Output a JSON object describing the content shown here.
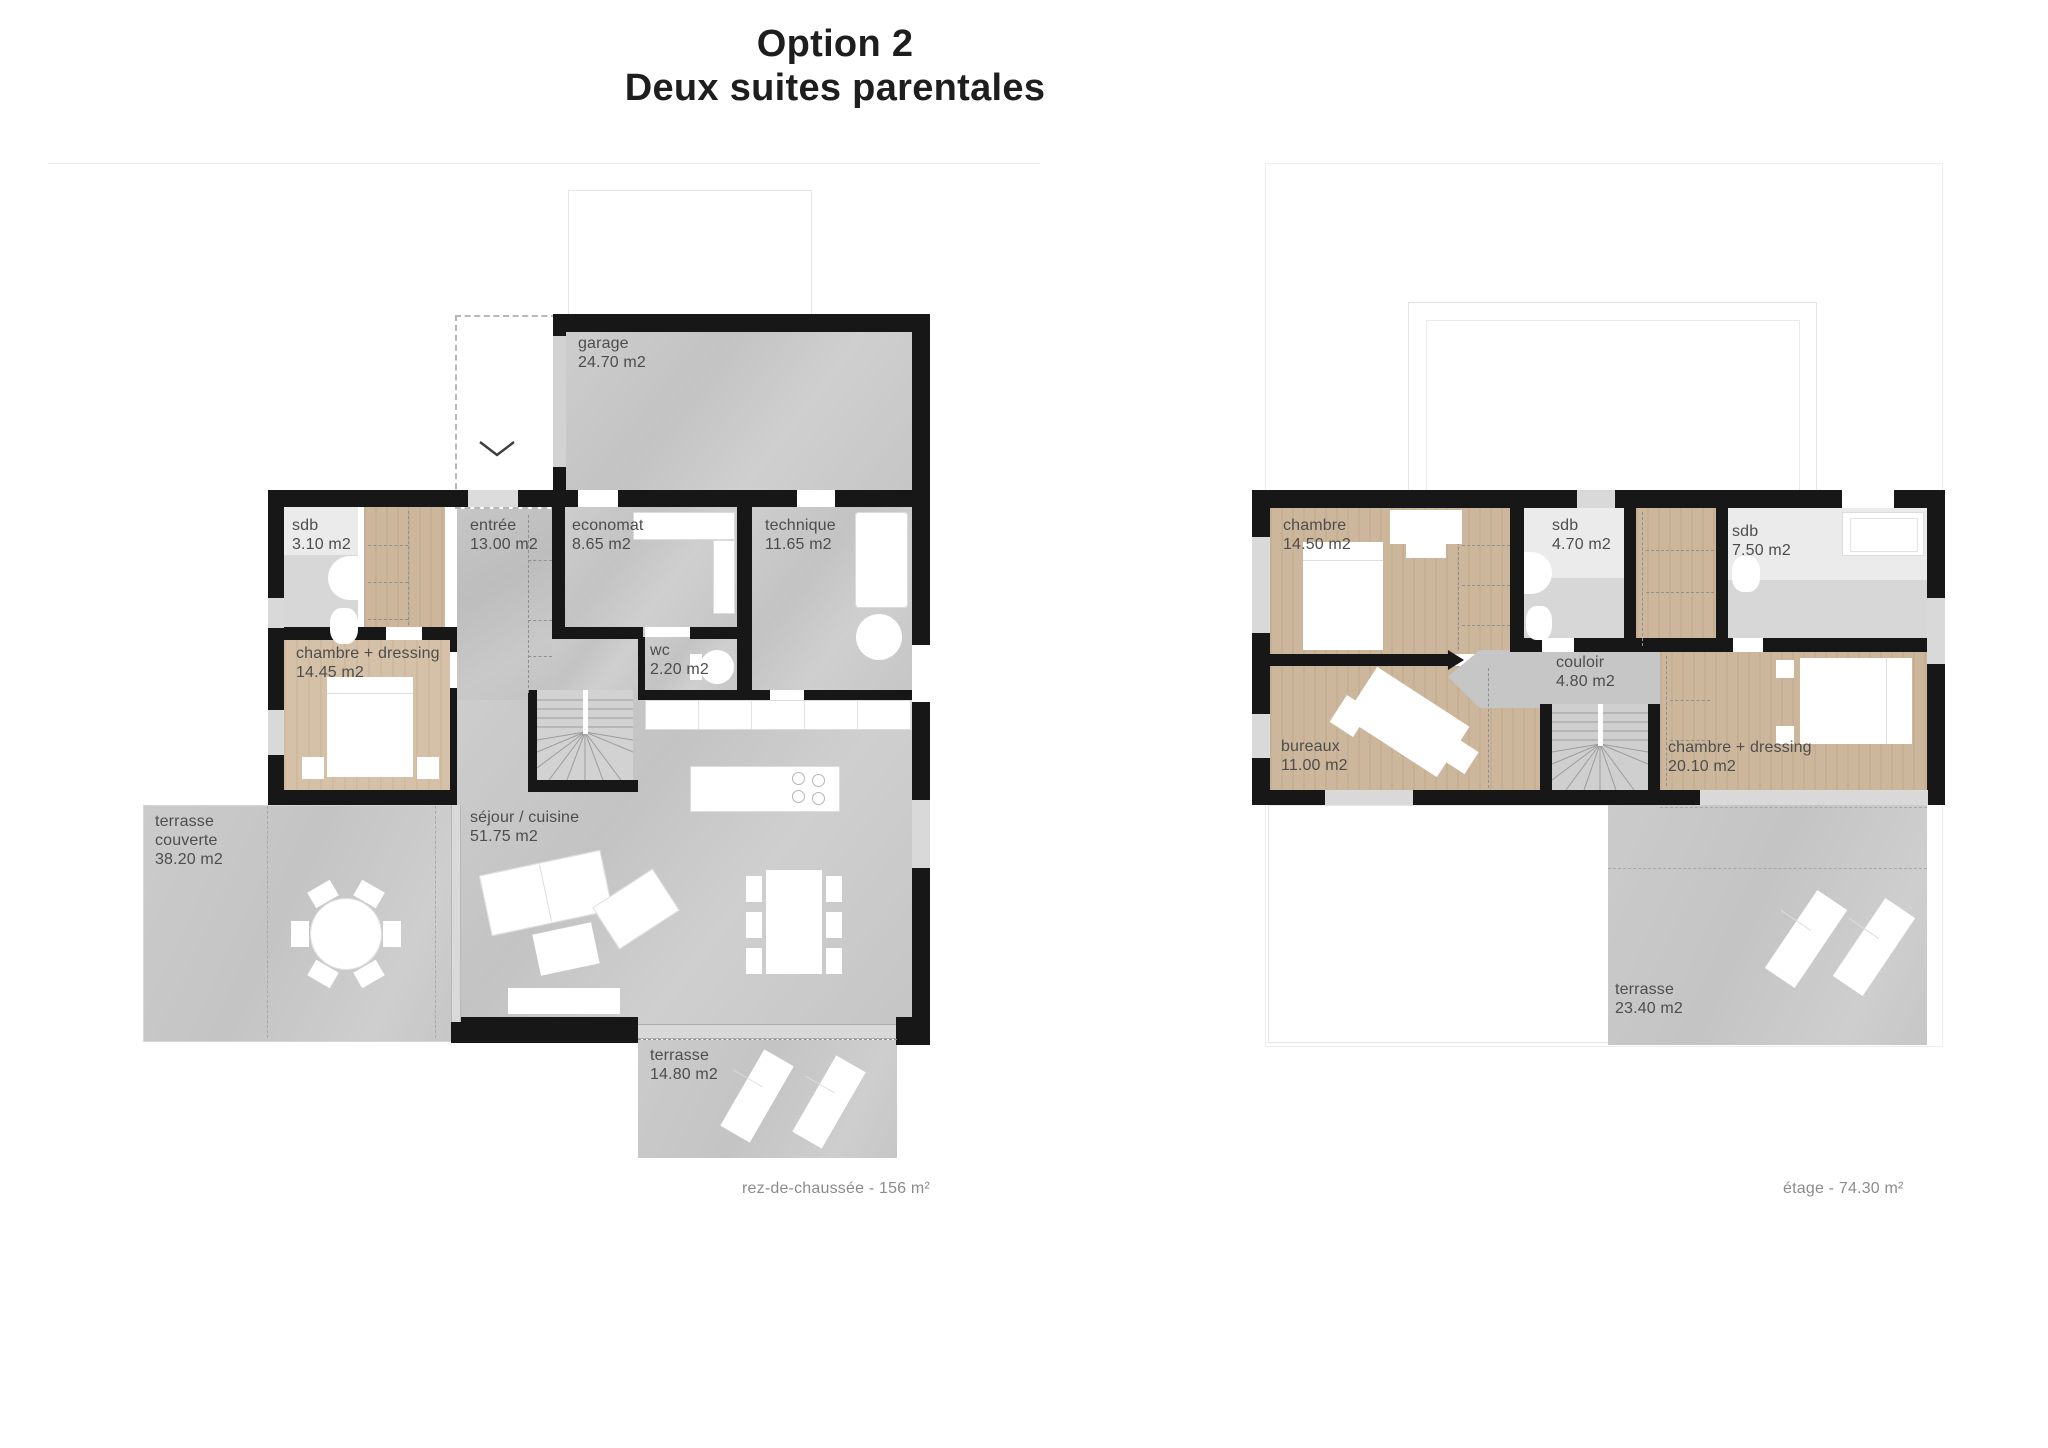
{
  "title": {
    "line1": "Option 2",
    "line2": "Deux suites parentales"
  },
  "plans": [
    {
      "name": "rez-de-chaussée",
      "caption": "rez-de-chaussée - 156 m²",
      "rooms": [
        {
          "label": "garage",
          "area": "24.70 m2"
        },
        {
          "label": "sdb",
          "area": "3.10 m2"
        },
        {
          "label": "entrée",
          "area": "13.00 m2"
        },
        {
          "label": "economat",
          "area": "8.65 m2"
        },
        {
          "label": "technique",
          "area": "11.65 m2"
        },
        {
          "label": "wc",
          "area": "2.20 m2"
        },
        {
          "label": "chambre + dressing",
          "area": "14.45 m2"
        },
        {
          "label": "terrasse couverte",
          "area": "38.20 m2"
        },
        {
          "label": "séjour / cuisine",
          "area": "51.75 m2"
        },
        {
          "label": "terrasse",
          "area": "14.80 m2"
        }
      ]
    },
    {
      "name": "étage",
      "caption": "étage - 74.30 m²",
      "rooms": [
        {
          "label": "chambre",
          "area": "14.50 m2"
        },
        {
          "label": "sdb",
          "area": "4.70 m2"
        },
        {
          "label": "sdb",
          "area": "7.50 m2"
        },
        {
          "label": "couloir",
          "area": "4.80 m2"
        },
        {
          "label": "bureaux",
          "area": "11.00 m2"
        },
        {
          "label": "chambre + dressing",
          "area": "20.10 m2"
        },
        {
          "label": "terrasse",
          "area": "23.40 m2"
        }
      ]
    }
  ],
  "colors": {
    "wall": "#171717",
    "concrete": "#c7c7c7",
    "wood": "#cdb79c",
    "wood_light": "#d5c1a8",
    "tile": "#ebebeb",
    "glazing": "#d9d9d9",
    "label_text": "#4d4d4d",
    "caption_text": "#8b8b8b"
  }
}
